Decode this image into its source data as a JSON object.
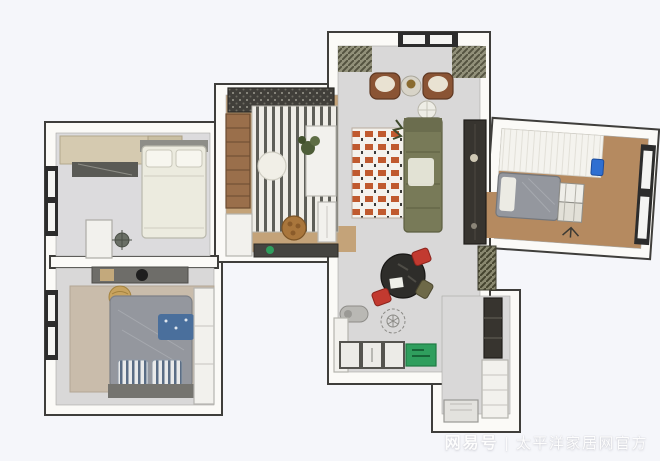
{
  "watermark": {
    "brand": "网易号",
    "separator": "|",
    "publisher": "太平洋家居网官方"
  },
  "colors": {
    "background": "#f5f6fa",
    "wall_fill": "#fbfaf7",
    "wall_stroke": "#3f3e3b",
    "floor_gray": "#d9d8d8",
    "floor_gray_light": "#dcdbdd",
    "floor_wood": "#c4a379",
    "floor_wood_dark": "#b58a60",
    "rug_beige": "#c9bcab",
    "rug_stripe_bg": "#efede7",
    "rug_stripe": "#5e5e58",
    "rug_checker_orange": "#c05a2e",
    "sofa_green": "#787a58",
    "armchair_brown": "#8a5434",
    "table_black": "#2e2d2a",
    "chair_red": "#c23a30",
    "chair_olive": "#6e6948",
    "appliance_green": "#2f9e5d",
    "bed_gray": "#94979e",
    "bed_white": "#ecebdf",
    "wardrobe_beige": "#d5cab0",
    "cabinet_dark": "#37342f",
    "cabinet_white": "#f2f1ed",
    "window_frame": "#2c2c2c",
    "pouf_tan": "#c8a35f",
    "blanket_blue": "#4a6f9c",
    "plant_green": "#4e5d38",
    "chair_blue": "#2f6fd1",
    "watermark_text": "#fdfdfd"
  }
}
